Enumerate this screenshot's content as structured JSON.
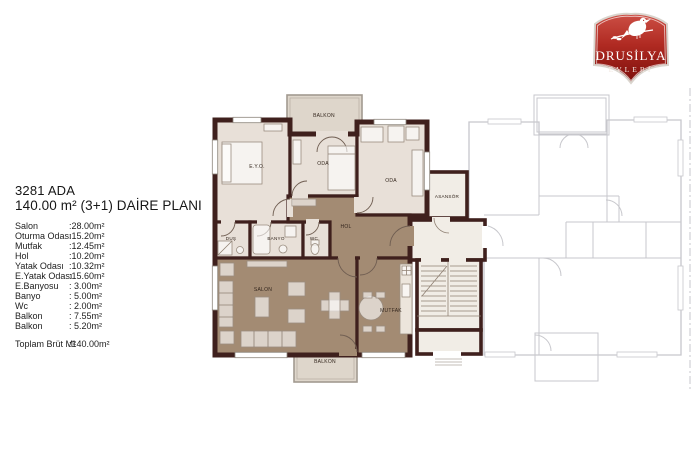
{
  "brand": {
    "name_line1": "DRUSİLYA",
    "name_line2": "EVLERİ",
    "badge_color_top": "#cc4f45",
    "badge_color_bottom": "#7c0f0b"
  },
  "header": {
    "block_title": "3281 ADA",
    "plan_title": "140.00 m² (3+1) DAİRE PLANI"
  },
  "area_table": {
    "rows": [
      {
        "label": "Salon",
        "value": ":28.00m²"
      },
      {
        "label": "Oturma Odası",
        "value": ":15.20m²"
      },
      {
        "label": "Mutfak",
        "value": ":12.45m²"
      },
      {
        "label": "Hol",
        "value": ":10.20m²"
      },
      {
        "label": "Yatak Odası",
        "value": ":10.32m²"
      },
      {
        "label": "E.Yatak Odası",
        "value": ":15.60m²"
      },
      {
        "label": "E.Banyosu",
        "value": ": 3.00m²"
      },
      {
        "label": "Banyo",
        "value": ": 5.00m²"
      },
      {
        "label": "Wc",
        "value": ": 2.00m²"
      },
      {
        "label": "Balkon",
        "value": ": 7.55m²"
      },
      {
        "label": "Balkon",
        "value": ": 5.20m²"
      }
    ],
    "total": {
      "label": "Toplam Brüt M²",
      "value": ":140.00m²"
    }
  },
  "floor_plan": {
    "labels": {
      "balkon_top": "BALKON",
      "eyo": "E.Y.O.",
      "oda_mid": "ODA",
      "oda_right": "ODA",
      "asansor": "ASANSÖR",
      "hol": "HOL",
      "dus": "DUŞ",
      "banyo": "BANYO",
      "wc": "WC",
      "salon": "SALON",
      "mutfak": "MUTFAK",
      "balkon_bottom": "BALKON"
    },
    "colors": {
      "wall": "#3f201d",
      "room_light": "#e8e0d8",
      "room_dark": "#a38b73",
      "balcony_fill": "#ded6cb",
      "core_fill": "#f1ede6",
      "faded_line": "#c7c7cc"
    }
  }
}
